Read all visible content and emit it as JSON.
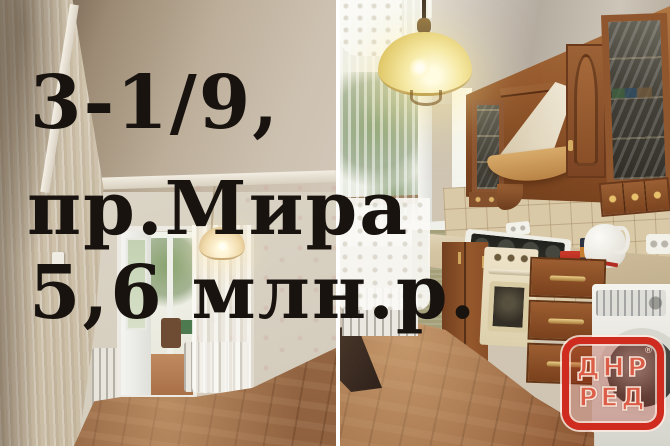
{
  "listing": {
    "line1": "3-1/9,",
    "line2": "пр.Мира",
    "line3": "5,6 млн.р.",
    "text_color": "#18130f"
  },
  "watermark": {
    "line1": "ДНР",
    "line2": "РЕД",
    "registered": "®",
    "frame_color": "#cf2b1e"
  }
}
